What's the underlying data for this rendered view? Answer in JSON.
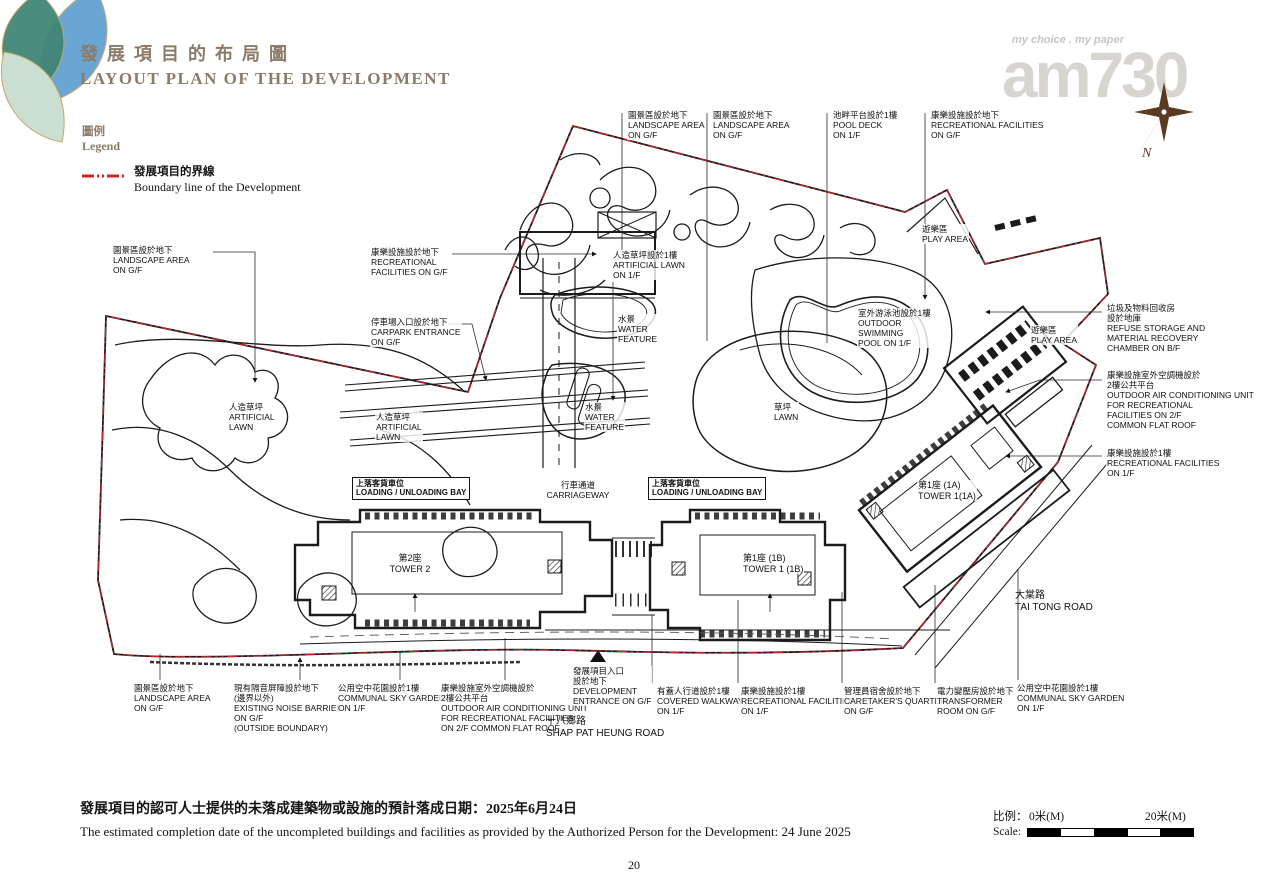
{
  "header": {
    "title_cn": "發展項目的布局圖",
    "title_en": "LAYOUT PLAN OF THE DEVELOPMENT",
    "logo": {
      "tagline": "my choice . my paper",
      "brand": "am730"
    },
    "compass_label": "N"
  },
  "legend": {
    "title_cn": "圖例",
    "title_en": "Legend",
    "boundary_cn": "發展項目的界線",
    "boundary_en": "Boundary line of the Development",
    "boundary_color": "#d42127"
  },
  "plan": {
    "entrance_marker": {
      "glyph": "▲",
      "x": 590,
      "y": 648
    },
    "annotations": [
      {
        "id": "anno-landscape-area-top-1",
        "x": 627,
        "y": 110,
        "text": "園景區設於地下\nLANDSCAPE AREA\nON G/F"
      },
      {
        "id": "anno-landscape-area-top-2",
        "x": 712,
        "y": 110,
        "text": "園景區設於地下\nLANDSCAPE AREA\nON G/F"
      },
      {
        "id": "anno-pool-deck",
        "x": 832,
        "y": 110,
        "text": "池畔平台設於1樓\nPOOL DECK\nON 1/F"
      },
      {
        "id": "anno-recreational-facilities-top",
        "x": 930,
        "y": 110,
        "text": "康樂設施設於地下\nRECREATIONAL FACILITIES\nON G/F"
      },
      {
        "id": "anno-landscape-area-left",
        "x": 112,
        "y": 245,
        "text": "園景區設於地下\nLANDSCAPE AREA\nON G/F"
      },
      {
        "id": "anno-recreational-facilities-left",
        "x": 370,
        "y": 247,
        "text": "康樂設施設於地下\nRECREATIONAL\nFACILITIES ON G/F"
      },
      {
        "id": "anno-carpark-entrance",
        "x": 370,
        "y": 317,
        "text": "停車場入口設於地下\nCARPARK ENTRANCE\nON G/F"
      },
      {
        "id": "anno-artificial-lawn-1f",
        "x": 612,
        "y": 250,
        "text": "人造草坪設於1樓\nARTIFICIAL LAWN\nON 1/F"
      },
      {
        "id": "anno-water-feature-1",
        "x": 617,
        "y": 314,
        "text": "水景\nWATER\nFEATURE"
      },
      {
        "id": "anno-water-feature-2",
        "x": 584,
        "y": 402,
        "text": "水景\nWATER\nFEATURE"
      },
      {
        "id": "anno-artificial-lawn-left",
        "x": 228,
        "y": 402,
        "text": "人造草坪\nARTIFICIAL\nLAWN"
      },
      {
        "id": "anno-artificial-lawn-mid",
        "x": 375,
        "y": 412,
        "text": "人造草坪\nARTIFICIAL\nLAWN"
      },
      {
        "id": "anno-lawn",
        "x": 773,
        "y": 402,
        "text": "草坪\nLAWN"
      },
      {
        "id": "anno-play-area-1",
        "x": 921,
        "y": 224,
        "text": "遊樂區\nPLAY AREA"
      },
      {
        "id": "anno-outdoor-swimming-pool",
        "x": 857,
        "y": 308,
        "text": "室外游泳池設於1樓\nOUTDOOR\nSWIMMING\nPOOL ON 1/F"
      },
      {
        "id": "anno-play-area-2",
        "x": 1030,
        "y": 325,
        "text": "遊樂區\nPLAY AREA"
      },
      {
        "id": "anno-refuse-storage",
        "x": 1106,
        "y": 303,
        "text": "垃圾及物料回收房\n設於地庫\nREFUSE STORAGE AND\nMATERIAL RECOVERY\nCHAMBER ON B/F"
      },
      {
        "id": "anno-ac-unit-right",
        "x": 1106,
        "y": 370,
        "text": "康樂設施室外空調機設於\n2樓公共平台\nOUTDOOR AIR CONDITIONING UNIT\nFOR RECREATIONAL\nFACILITIES ON 2/F\nCOMMON FLAT ROOF"
      },
      {
        "id": "anno-recreational-facilities-right",
        "x": 1106,
        "y": 448,
        "text": "康樂設施設於1樓\nRECREATIONAL FACILITIES\nON 1/F"
      },
      {
        "id": "anno-tower-1a",
        "x": 917,
        "y": 480,
        "cls": "tower",
        "text": "第1座 (1A)\nTOWER 1(1A)"
      },
      {
        "id": "anno-tai-tong-road",
        "x": 1014,
        "y": 590,
        "cls": "road",
        "text": "大棠路\nTAI TONG ROAD"
      },
      {
        "id": "anno-loading-bay-left",
        "x": 352,
        "y": 477,
        "boxed": true,
        "text": "上落客貨車位\nLOADING / UNLOADING BAY"
      },
      {
        "id": "anno-carriageway",
        "x": 578,
        "y": 480,
        "cls": "center",
        "text": "行車通道\nCARRIAGEWAY"
      },
      {
        "id": "anno-loading-bay-right",
        "x": 648,
        "y": 477,
        "boxed": true,
        "text": "上落客貨車位\nLOADING / UNLOADING BAY"
      },
      {
        "id": "anno-tower-2",
        "x": 410,
        "y": 553,
        "cls": "tower center",
        "text": "第2座\nTOWER 2"
      },
      {
        "id": "anno-tower-1b",
        "x": 742,
        "y": 553,
        "cls": "tower",
        "text": "第1座 (1B)\nTOWER 1 (1B)"
      },
      {
        "id": "anno-landscape-area-bottom",
        "x": 133,
        "y": 683,
        "text": "園景區設於地下\nLANDSCAPE AREA\nON G/F"
      },
      {
        "id": "anno-noise-barrier",
        "x": 233,
        "y": 683,
        "text": "現有隔音屏障設於地下\n(邊界以外)\nEXISTING NOISE BARRIER\nON G/F\n(OUTSIDE BOUNDARY)"
      },
      {
        "id": "anno-sky-garden-left",
        "x": 337,
        "y": 683,
        "text": "公用空中花園設於1樓\nCOMMUNAL SKY GARDEN\nON 1/F"
      },
      {
        "id": "anno-ac-unit-bottom",
        "x": 440,
        "y": 683,
        "text": "康樂設施室外空調機設於\n2樓公共平台\nOUTDOOR AIR CONDITIONING UNIT\nFOR RECREATIONAL FACILITIES\nON 2/F COMMON FLAT ROOF"
      },
      {
        "id": "anno-development-entrance",
        "x": 572,
        "y": 666,
        "text": "發展項目入口\n設於地下\nDEVELOPMENT\nENTRANCE ON G/F"
      },
      {
        "id": "anno-covered-walkway",
        "x": 656,
        "y": 686,
        "text": "有蓋人行道設於1樓\nCOVERED WALKWAY\nON 1/F"
      },
      {
        "id": "anno-recreational-facilities-bottom",
        "x": 740,
        "y": 686,
        "text": "康樂設施設於1樓\nRECREATIONAL FACILITIES\nON 1/F"
      },
      {
        "id": "anno-caretakers-quarter",
        "x": 843,
        "y": 686,
        "text": "管理員宿舍設於地下\nCARETAKER'S QUARTER\nON G/F"
      },
      {
        "id": "anno-transformer-room",
        "x": 936,
        "y": 686,
        "text": "電力變壓房設於地下\nTRANSFORMER\nROOM ON G/F"
      },
      {
        "id": "anno-sky-garden-right",
        "x": 1016,
        "y": 683,
        "text": "公用空中花園設於1樓\nCOMMUNAL SKY GARDEN\nON 1/F"
      },
      {
        "id": "anno-shap-pat-heung-road",
        "x": 545,
        "y": 716,
        "cls": "road",
        "text": "十八鄉路\nSHAP PAT HEUNG ROAD"
      }
    ]
  },
  "footer": {
    "completion_cn": "發展項目的認可人士提供的未落成建築物或設施的預計落成日期：2025年6月24日",
    "completion_en": "The estimated completion date of the uncompleted buildings and facilities as provided by the Authorized Person for the Development: 24 June 2025",
    "scale_label_cn": "比例：",
    "scale_label_en": "Scale:",
    "scale_start": "0米(M)",
    "scale_end": "20米(M)",
    "page_number": "20"
  }
}
